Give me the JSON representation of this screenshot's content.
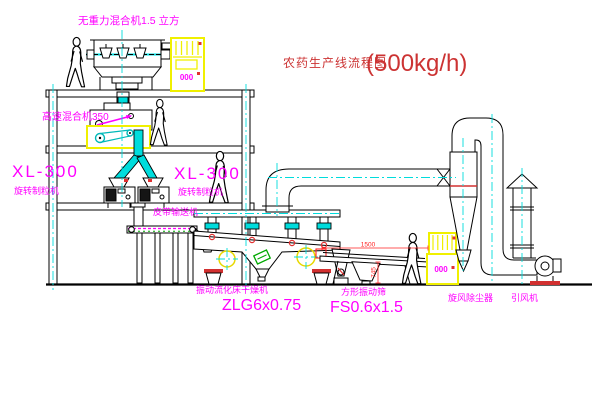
{
  "diagram": {
    "title": "农药生产线流程图",
    "title_capacity": "(500kg/h)",
    "labels": {
      "gravity_mixer": "无重力混合机1.5 立方",
      "high_speed_mixer": "高速混合机350",
      "granulator_left_model": "XL-300",
      "granulator_left_name": "旋转制粒机",
      "granulator_right_model": "XL-300",
      "granulator_right_name": "旋转制粒机",
      "belt_conveyor": "皮带输送机",
      "dryer_name": "振动流化床干燥机",
      "dryer_model": "ZLG6x0.75",
      "screen_name": "方形振动筛",
      "screen_model": "FS0.6x1.5",
      "cyclone": "旋风除尘器",
      "fan": "引风机"
    },
    "dimensions": {
      "screen_length": "1500",
      "screen_height": "745"
    },
    "control_cabinets": {
      "cabinet_1_display": "000",
      "cabinet_2_display": "000"
    },
    "colors": {
      "label_magenta": "#ff00ff",
      "title_red": "#cc3333",
      "dimension_red": "#ff2222",
      "pipe_cyan": "#00dcdc",
      "cabinet_yellow": "#f0f000",
      "drum_green": "#00a800"
    }
  }
}
